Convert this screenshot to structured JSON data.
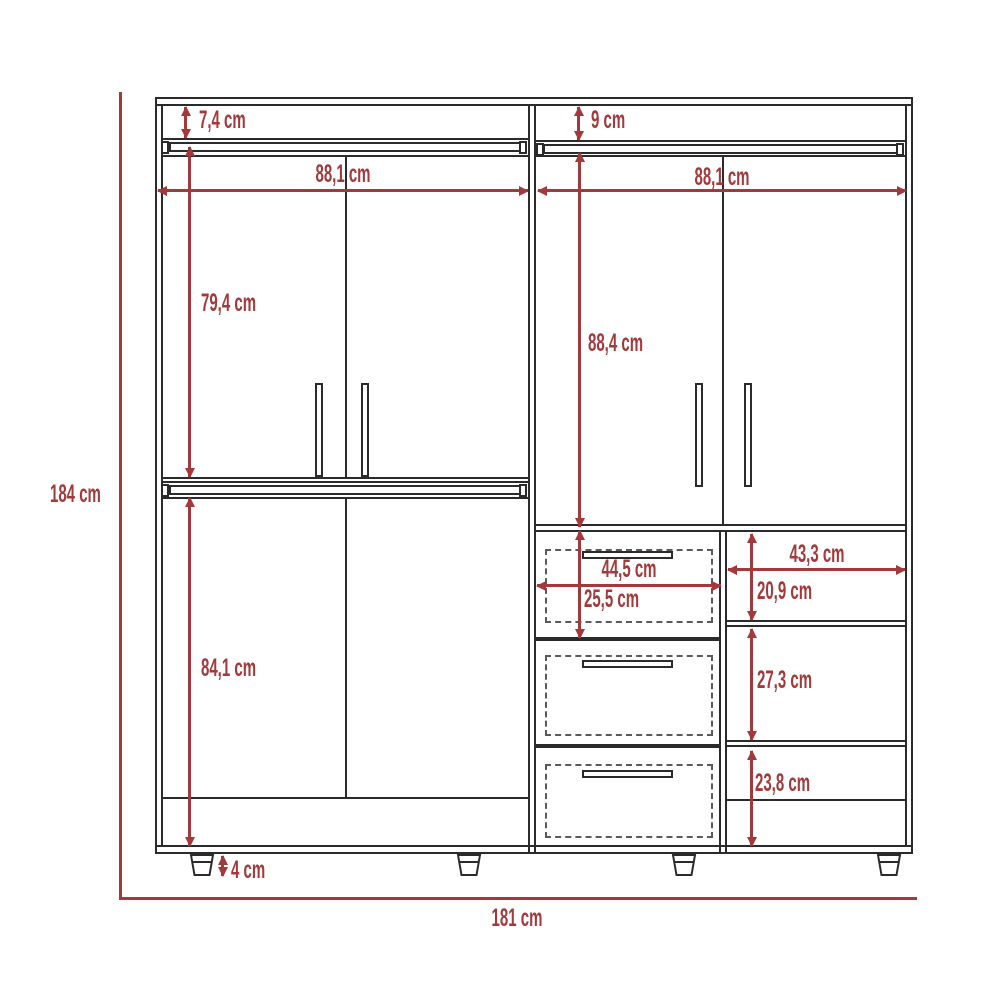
{
  "unit": "cm",
  "colors": {
    "dimension_red": "#A4393B",
    "outline": "#2B2B2B",
    "background": "#FFFFFF"
  },
  "dimensions": {
    "total_height": "184 cm",
    "total_width": "181 cm",
    "top_gap_left": "7,4 cm",
    "top_gap_right": "9 cm",
    "left_section_width": "88,1 cm",
    "right_section_width": "88,1 cm",
    "left_upper_door_height": "79,4 cm",
    "left_lower_door_height": "84,1 cm",
    "right_door_height": "88,4 cm",
    "drawer_width": "44,5 cm",
    "top_drawer_height": "25,5 cm",
    "shelf_section_width": "43,3 cm",
    "shelf_top_height": "20,9 cm",
    "shelf_middle_height": "27,3 cm",
    "shelf_bottom_height": "23,8 cm",
    "foot_height": "4 cm"
  }
}
